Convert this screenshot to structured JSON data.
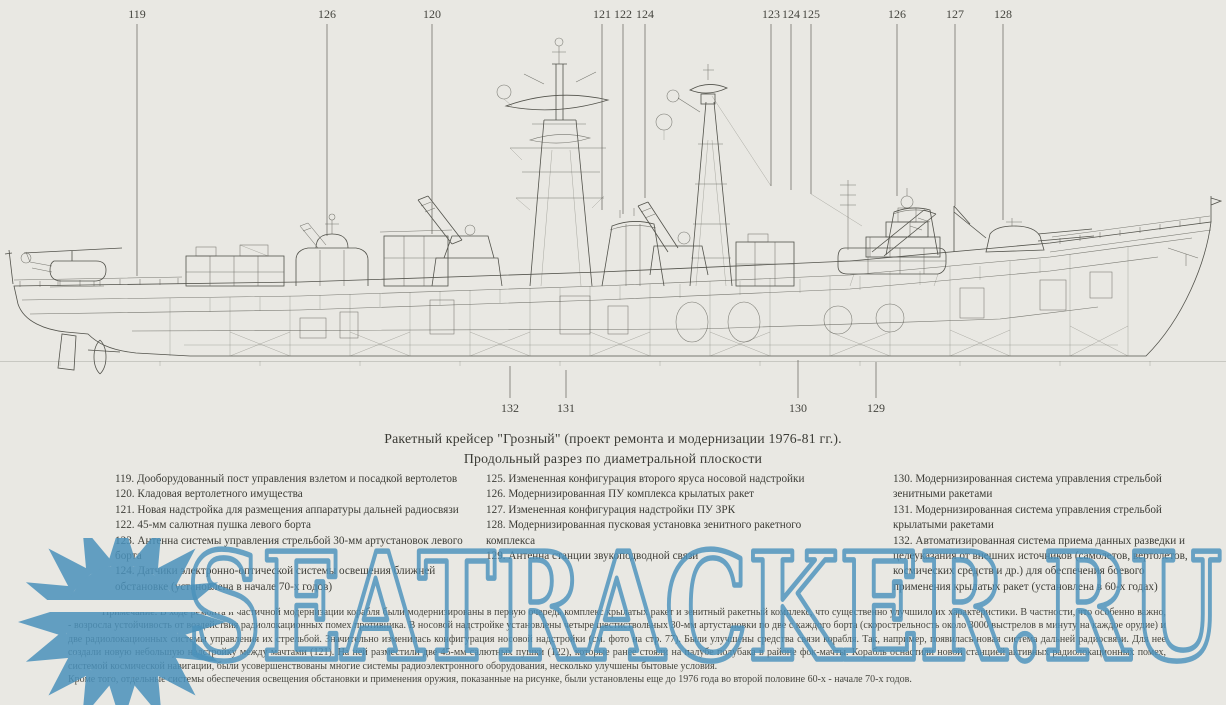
{
  "title": {
    "line1": "Ракетный крейсер \"Грозный\" (проект ремонта и модернизации 1976-81 гг.).",
    "line2": "Продольный разрез по диаметральной плоскости"
  },
  "callouts": {
    "top": [
      "119",
      "126",
      "120",
      "121",
      "122",
      "124",
      "123",
      "124",
      "125",
      "126",
      "127",
      "128"
    ],
    "bottom": [
      "132",
      "131",
      "130",
      "129"
    ]
  },
  "legend": {
    "col1": [
      {
        "num": "119.",
        "text": "Дооборудованный пост управления взлетом и посадкой вертолетов"
      },
      {
        "num": "120.",
        "text": "Кладовая вертолетного имущества"
      },
      {
        "num": "121.",
        "text": "Новая надстройка для размещения аппаратуры дальней радиосвязи"
      },
      {
        "num": "122.",
        "text": "45-мм салютная пушка левого борта"
      },
      {
        "num": "123.",
        "text": "Антенна системы управления стрельбой 30-мм артустановок левого борта"
      },
      {
        "num": "124.",
        "text": "Датчики электронно-оптической системы освещения ближней обстановке (установлена в начале 70-х годов)"
      }
    ],
    "col2": [
      {
        "num": "125.",
        "text": "Измененная конфигурация второго яруса носовой надстройки"
      },
      {
        "num": "126.",
        "text": "Модернизированная ПУ комплекса крылатых ракет"
      },
      {
        "num": "127.",
        "text": "Измененная конфигурация надстройки ПУ ЗРК"
      },
      {
        "num": "128.",
        "text": "Модернизированная пусковая установка зенитного ракетного комплекса"
      },
      {
        "num": "129.",
        "text": "Антенна станции звукоподводной связи"
      }
    ],
    "col3": [
      {
        "num": "130.",
        "text": "Модернизированная система управления стрельбой зенитными ракетами"
      },
      {
        "num": "131.",
        "text": "Модернизированная система управления стрельбой крылатыми ракетами"
      },
      {
        "num": "132.",
        "text": "Автоматизированная система приема данных разведки и целеуказания от внешних источников (самолетов, вертолетов, космических средств и др.) для обеспечения боевого применения крылатых ракет (установлена в 60-х годах)"
      }
    ]
  },
  "note": {
    "para1": "Примечание. В ходе ремонта и частичной модернизации корабля были модернизированы в первую очередь комплекс крылатых ракет и зенитный ракетный комплекс, что существенно улучшило их характеристики. В частности, что особенно важно, - возросла устойчивость от воздействия радиолокационных помех противника. В носовой надстройке установлены четыре шестиствольных 30-мм артустановки по две с каждого борта (скорострельность около 3000 выстрелов в минуту на каждое орудие) и две радиолокационных системы управления их стрельбой. Значительно изменилась конфигурация носовой надстройки (см. фото на стр. 77). Были улучшены средства связи корабля. Так, например, появилась новая система дальней радиосвязи. Для нее создали новую небольшую надстройку между мачтами (121). На ней разместили две 45-мм салютных пушки (122), которые ранее стояли на палубе полубака в районе фок-мачты. Корабль оснастили новой станцией активных радиолокационных помех, системой космической навигации, были усовершенствованы многие системы радиоэлектронного оборудования, несколько улучшены бытовые условия.",
    "para2": "Кроме того, отдельные системы обеспечения освещения обстановки и применения оружия, показанные на рисунке, были установлены еще до 1976 года во второй половине 60-х - начале 70-х годов."
  },
  "watermark": {
    "text": "SEATRACKER.RU",
    "color": "#4b92bc"
  },
  "colors": {
    "paper": "#e9e8e3",
    "ink": "#52524b"
  }
}
